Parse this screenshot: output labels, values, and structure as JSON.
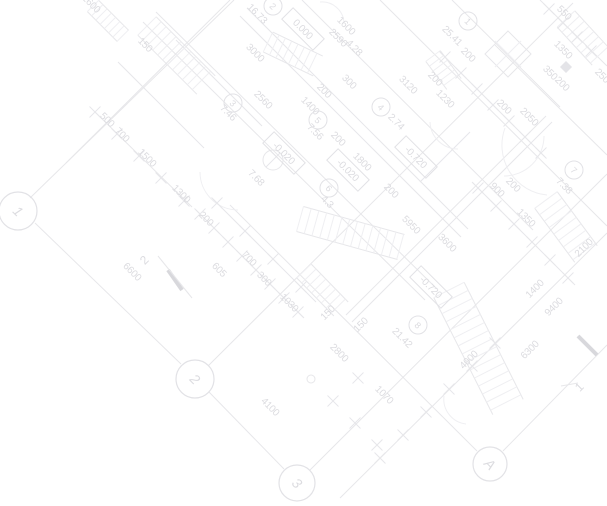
{
  "title": "Architectural floor plan blueprint (rotated 45°, faint gray linework)",
  "canvas": {
    "width": 607,
    "height": 506,
    "background": "#ffffff"
  },
  "colors": {
    "line_main": "#e7e7ea",
    "line_faint": "#efeff2",
    "text": "#dcdce0",
    "box_stroke": "#e2e2e6",
    "thick": "#d8d8dc",
    "fill_symbol": "#e4e4e8"
  },
  "grid_bubbles": [
    {
      "label": "1",
      "x": 18,
      "y": 211,
      "r": 19
    },
    {
      "label": "2",
      "x": 195,
      "y": 379,
      "r": 19
    },
    {
      "label": "3",
      "x": 297,
      "y": 483,
      "r": 18
    },
    {
      "label": "A",
      "x": 490,
      "y": 464,
      "r": 17
    }
  ],
  "room_stamps": [
    {
      "number": "1",
      "x": 468,
      "y": 21,
      "area": "25.41"
    },
    {
      "number": "2",
      "x": 273,
      "y": 6,
      "area": "16.73"
    },
    {
      "number": "3",
      "x": 233,
      "y": 103,
      "area": "7.46"
    },
    {
      "number": "4",
      "x": 381,
      "y": 107,
      "area": "2.74"
    },
    {
      "number": "5",
      "x": 318,
      "y": 120,
      "area": "7.56"
    },
    {
      "number": "6",
      "x": 329,
      "y": 188,
      "area": "4.3"
    },
    {
      "number": "7",
      "x": 574,
      "y": 170,
      "area": "7.38"
    },
    {
      "number": "8",
      "x": 418,
      "y": 325,
      "area": "21.42"
    }
  ],
  "elevation_marks": [
    {
      "text": "0.000",
      "x": 303,
      "y": 29
    },
    {
      "text": "-0.020",
      "x": 284,
      "y": 153
    },
    {
      "text": "-0.020",
      "x": 348,
      "y": 170
    },
    {
      "text": "-0.720",
      "x": 416,
      "y": 157
    },
    {
      "text": "-0.720",
      "x": 431,
      "y": 287
    }
  ],
  "dimension_labels": [
    [
      "2600",
      89,
      6,
      45
    ],
    [
      "150",
      143,
      47,
      45
    ],
    [
      "3000",
      253,
      55,
      45
    ],
    [
      "16.73",
      255,
      16,
      45
    ],
    [
      "1600",
      344,
      28,
      45
    ],
    [
      "2590",
      336,
      40,
      45
    ],
    [
      "4.28",
      352,
      50,
      45
    ],
    [
      "2560",
      261,
      102,
      45
    ],
    [
      "7.46",
      226,
      115,
      45
    ],
    [
      "500",
      105,
      122,
      45
    ],
    [
      "700",
      120,
      137,
      45
    ],
    [
      "1500",
      145,
      160,
      45
    ],
    [
      "1300",
      179,
      196,
      45
    ],
    [
      "7.68",
      254,
      180,
      45
    ],
    [
      "1400",
      308,
      108,
      45
    ],
    [
      "200",
      322,
      93,
      45
    ],
    [
      "7.56",
      313,
      134,
      45
    ],
    [
      "200",
      336,
      141,
      45
    ],
    [
      "2.74",
      394,
      124,
      45
    ],
    [
      "300",
      347,
      84,
      45
    ],
    [
      "1800",
      360,
      164,
      45
    ],
    [
      "4.3",
      325,
      204,
      45
    ],
    [
      "3120",
      406,
      87,
      45
    ],
    [
      "200",
      433,
      81,
      45
    ],
    [
      "1230",
      443,
      101,
      45
    ],
    [
      "200",
      502,
      109,
      45
    ],
    [
      "2050",
      527,
      119,
      45
    ],
    [
      "25.41",
      450,
      38,
      45
    ],
    [
      "200",
      466,
      57,
      45
    ],
    [
      "550",
      562,
      15,
      45
    ],
    [
      "1350",
      561,
      52,
      45
    ],
    [
      "350",
      548,
      75,
      45
    ],
    [
      "200",
      560,
      86,
      45
    ],
    [
      "250",
      600,
      78,
      45
    ],
    [
      "200",
      511,
      187,
      45
    ],
    [
      "900",
      495,
      192,
      45
    ],
    [
      "200",
      389,
      193,
      45
    ],
    [
      "5950",
      409,
      227,
      45
    ],
    [
      "3600",
      445,
      245,
      45
    ],
    [
      "7.38",
      562,
      188,
      45
    ],
    [
      "1350",
      524,
      220,
      45
    ],
    [
      "21.42",
      400,
      340,
      45
    ],
    [
      "150",
      330,
      315,
      -45
    ],
    [
      "150",
      363,
      327,
      -45
    ],
    [
      "2800",
      337,
      355,
      45
    ],
    [
      "1070",
      382,
      397,
      45
    ],
    [
      "4100",
      268,
      409,
      45
    ],
    [
      "6600",
      130,
      274,
      45
    ],
    [
      "200",
      204,
      221,
      45
    ],
    [
      "605",
      217,
      272,
      45
    ],
    [
      "700",
      247,
      261,
      45
    ],
    [
      "300",
      262,
      281,
      45
    ],
    [
      "1030",
      287,
      305,
      45
    ],
    [
      "2100",
      586,
      250,
      -45
    ],
    [
      "1400",
      537,
      291,
      -45
    ],
    [
      "9400",
      556,
      309,
      -45
    ],
    [
      "6300",
      532,
      352,
      -45
    ],
    [
      "4000",
      471,
      362,
      -45
    ]
  ],
  "section_markers": [
    {
      "label": "2",
      "lx": 147,
      "ly": 263,
      "x1": 168,
      "y1": 270,
      "x2": 182,
      "y2": 290,
      "tx1": 158,
      "ty1": 256,
      "tx2": 192,
      "ty2": 298
    },
    {
      "label": "1",
      "lx": 582,
      "ly": 390,
      "x1": 578,
      "y1": 336,
      "x2": 597,
      "y2": 355,
      "tx1": 561,
      "ty1": 386,
      "tx2": 578,
      "ty2": 383
    }
  ],
  "lines": [
    [
      30,
      198,
      234,
      0
    ],
    [
      66,
      163,
      230,
      0
    ],
    [
      208,
      366,
      573,
      3
    ],
    [
      310,
      470,
      607,
      174
    ],
    [
      340,
      498,
      607,
      233
    ],
    [
      35,
      223,
      181,
      364
    ],
    [
      209,
      392,
      284,
      469
    ],
    [
      230,
      205,
      477,
      451
    ],
    [
      503,
      451,
      607,
      345
    ],
    [
      143,
      22,
      425,
      300
    ],
    [
      156,
      12,
      437,
      289
    ],
    [
      247,
      8,
      468,
      229
    ],
    [
      240,
      16,
      461,
      237
    ],
    [
      302,
      0,
      533,
      230
    ],
    [
      380,
      0,
      607,
      226
    ],
    [
      352,
      322,
      552,
      122
    ],
    [
      346,
      315,
      546,
      116
    ],
    [
      452,
      0,
      560,
      107
    ],
    [
      495,
      45,
      607,
      155
    ],
    [
      95,
      112,
      192,
      207
    ],
    [
      196,
      210,
      304,
      318
    ],
    [
      213,
      199,
      316,
      302
    ],
    [
      440,
      52,
      545,
      157
    ],
    [
      540,
      0,
      607,
      66
    ],
    [
      472,
      182,
      575,
      285
    ],
    [
      176,
      40,
      262,
      126
    ],
    [
      118,
      62,
      204,
      148
    ],
    [
      420,
      182,
      470,
      132
    ]
  ],
  "stair_bands": [
    [
      147,
      26,
      206,
      85,
      13,
      7
    ],
    [
      268,
      42,
      318,
      66,
      11,
      7
    ],
    [
      300,
      219,
      401,
      247,
      13,
      8
    ],
    [
      449,
      290,
      508,
      407,
      17,
      9
    ],
    [
      546,
      200,
      586,
      254,
      14,
      8
    ],
    [
      566,
      19,
      601,
      57,
      12,
      7
    ],
    [
      433,
      56,
      454,
      84,
      9,
      6
    ],
    [
      304,
      271,
      341,
      309,
      10,
      7
    ],
    [
      93,
      6,
      123,
      36,
      8,
      6
    ]
  ],
  "ticks": [
    [
      95,
      112
    ],
    [
      117,
      134
    ],
    [
      139,
      156
    ],
    [
      161,
      178
    ],
    [
      184,
      201
    ],
    [
      200,
      214
    ],
    [
      214,
      228
    ],
    [
      228,
      242
    ],
    [
      242,
      256
    ],
    [
      256,
      270
    ],
    [
      270,
      284
    ],
    [
      284,
      298
    ],
    [
      298,
      312
    ],
    [
      217,
      203
    ],
    [
      245,
      231
    ],
    [
      273,
      259
    ],
    [
      301,
      287
    ],
    [
      445,
      57
    ],
    [
      461,
      73
    ],
    [
      477,
      89
    ],
    [
      493,
      105
    ],
    [
      509,
      121
    ],
    [
      525,
      137
    ],
    [
      541,
      153
    ],
    [
      549,
      9
    ],
    [
      563,
      23
    ],
    [
      577,
      37
    ],
    [
      591,
      51
    ],
    [
      478,
      188
    ],
    [
      496,
      206
    ],
    [
      514,
      224
    ],
    [
      532,
      242
    ],
    [
      550,
      260
    ],
    [
      568,
      278
    ],
    [
      380,
      458
    ],
    [
      403,
      435
    ],
    [
      426,
      412
    ],
    [
      449,
      389
    ],
    [
      472,
      366
    ],
    [
      495,
      343
    ],
    [
      333,
      401
    ],
    [
      355,
      423
    ],
    [
      377,
      445
    ],
    [
      358,
      378
    ]
  ],
  "door_arcs": [
    "M 200 172 A 38 38 0 0 0 238 210",
    "M 544 136 A 40 40 0 0 1 504 176",
    "M 320 2 A 22 22 0 0 1 344 23",
    "M 430 122 A 28 28 0 0 0 458 149",
    "M 444 396 A 25 25 0 0 0 466 424",
    "M 505 128 A 50 50 0 0 0 547 195"
  ],
  "symbols": {
    "shaft_square": {
      "cx": 508,
      "cy": 54,
      "half": 23
    },
    "filled_square": {
      "cx": 566,
      "cy": 67,
      "half": 6
    },
    "survey_marker": {
      "cx": 273,
      "cy": 160,
      "r": 10
    },
    "small_circle": {
      "cx": 311,
      "cy": 379,
      "r": 4
    }
  }
}
